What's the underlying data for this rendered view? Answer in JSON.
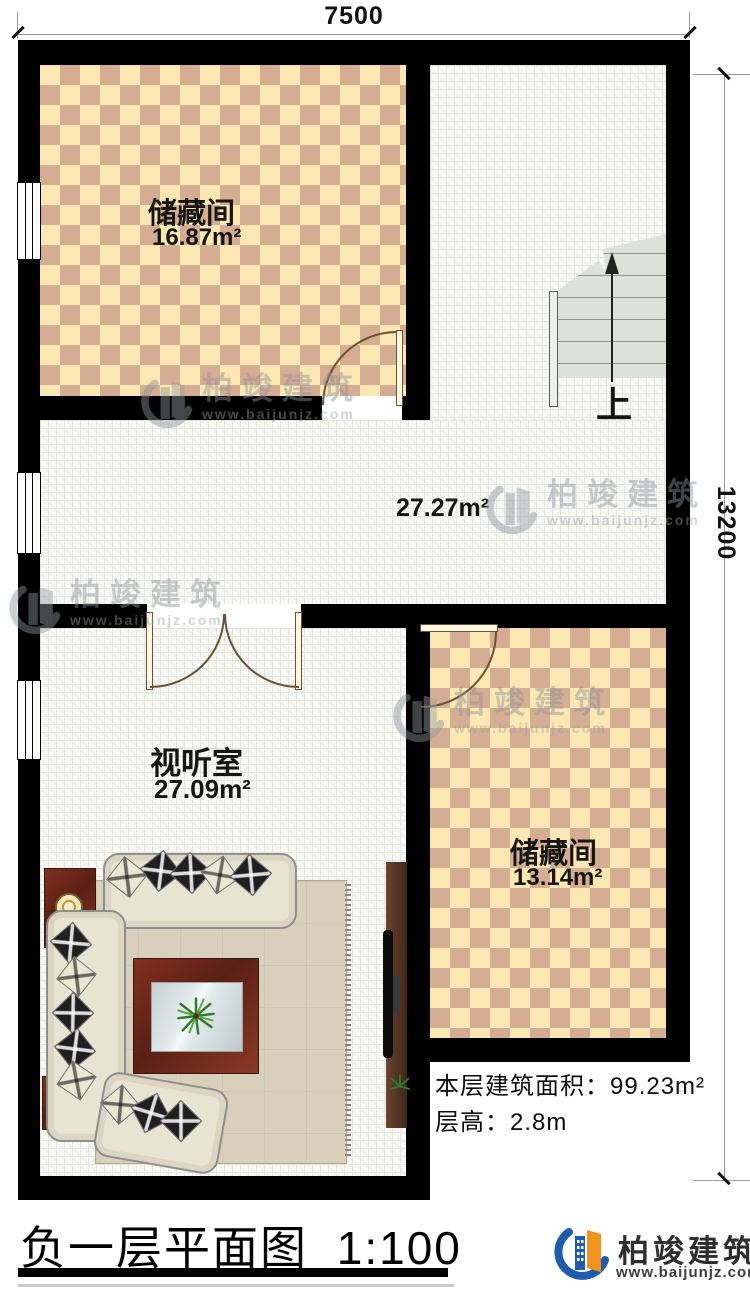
{
  "plan": {
    "dim_top": "7500",
    "dim_right": "13200",
    "rooms": {
      "storage1": {
        "name": "储藏间",
        "area": "16.87m²"
      },
      "hall": {
        "area": "27.27m²"
      },
      "av_room": {
        "name": "视听室",
        "area": "27.09m²"
      },
      "storage2": {
        "name": "储藏间",
        "area": "13.14m²"
      }
    },
    "stairs_label": "上"
  },
  "notes": {
    "floor_area_label": "本层建筑面积：",
    "floor_area_value": "99.23m²",
    "floor_height_label": "层高：",
    "floor_height_value": "2.8m"
  },
  "footer": {
    "title": "负一层平面图",
    "scale": "1:100",
    "brand_name": "柏竣建筑",
    "brand_url": "www.baijunjz.com"
  },
  "watermark": {
    "name": "柏竣建筑",
    "url": "www.baijunjz.com"
  },
  "colors": {
    "wall": "#000000",
    "checker_light": "#fbe7b2",
    "checker_dark": "#d4ad92",
    "tile_floor": "#f8f8f5",
    "stairs": "#dce2d7",
    "brand_blue": "#1e5cad",
    "brand_orange": "#f0941f",
    "watermark_gray": "#8d949b"
  }
}
